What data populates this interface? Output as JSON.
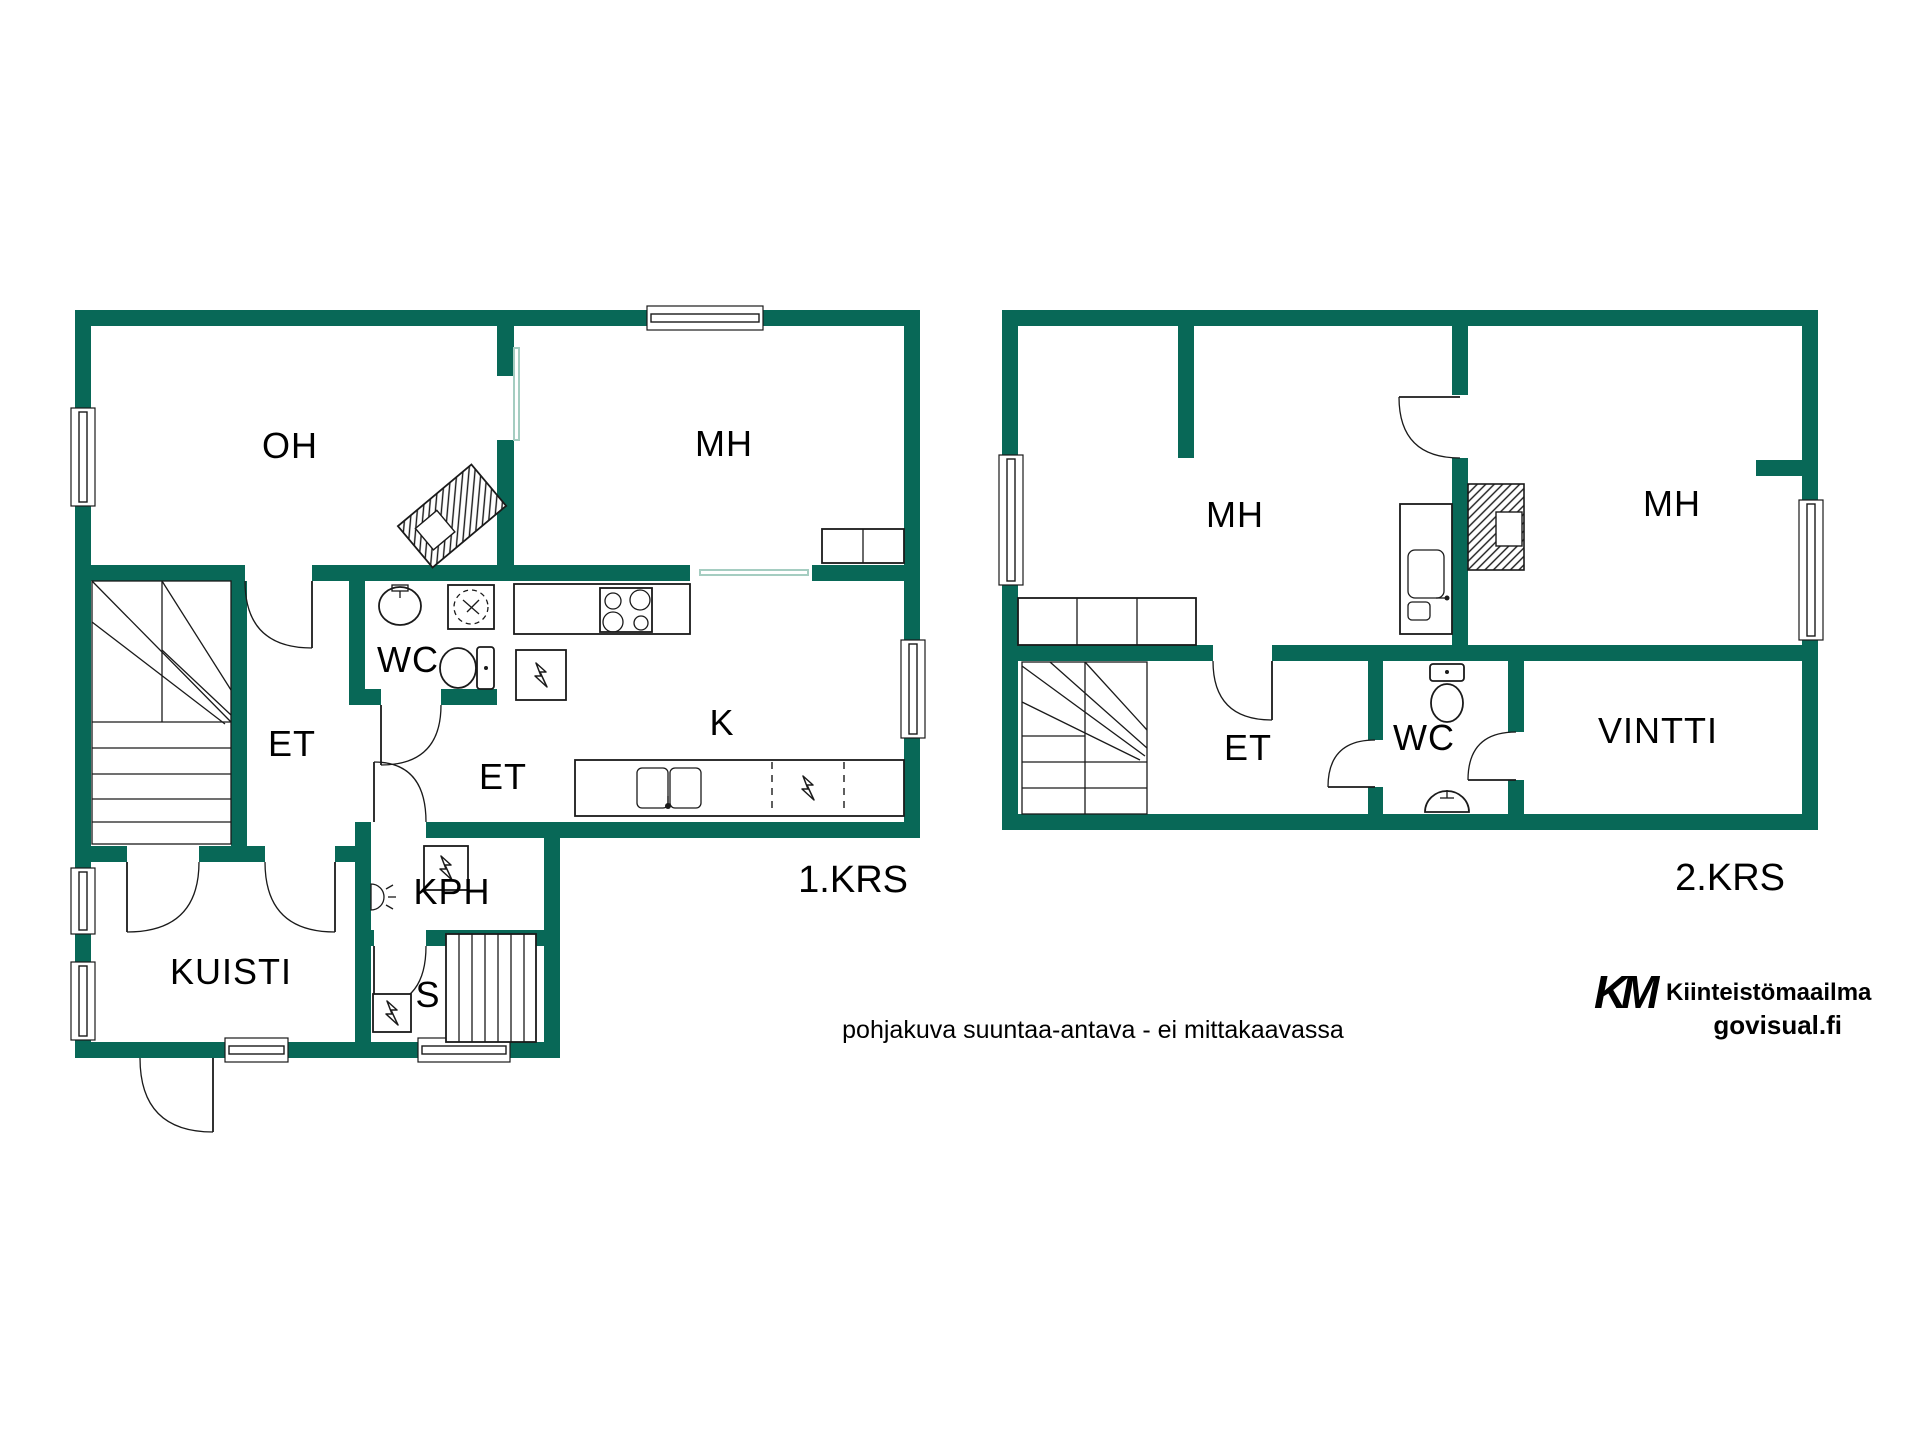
{
  "document": {
    "type": "floor-plan"
  },
  "colors": {
    "wall": "#086857",
    "line": "#1a1a1a",
    "sliding_door": "#a5cdc1",
    "disclaimer_text": "#a8a8a8",
    "logo_k": "#3cb95f",
    "logo_m": "#176a50",
    "logo_text": "#1b5c4b",
    "watermark_text": "#b7bab9"
  },
  "floors": [
    {
      "name": "1.KRS",
      "rooms": [
        {
          "id": "oh",
          "label": "OH"
        },
        {
          "id": "mh",
          "label": "MH"
        },
        {
          "id": "wc",
          "label": "WC"
        },
        {
          "id": "et-hall",
          "label": "ET"
        },
        {
          "id": "et-back",
          "label": "ET"
        },
        {
          "id": "k",
          "label": "K"
        },
        {
          "id": "kph",
          "label": "KPH"
        },
        {
          "id": "s",
          "label": "S"
        },
        {
          "id": "kuisti",
          "label": "KUISTI"
        }
      ]
    },
    {
      "name": "2.KRS",
      "rooms": [
        {
          "id": "mh-left",
          "label": "MH"
        },
        {
          "id": "mh-right",
          "label": "MH"
        },
        {
          "id": "et",
          "label": "ET"
        },
        {
          "id": "wc",
          "label": "WC"
        },
        {
          "id": "vintti",
          "label": "VINTTI"
        }
      ]
    }
  ],
  "footer": {
    "disclaimer": "pohjakuva suuntaa-antava - ei mittakaavassa"
  },
  "logo": {
    "k": "K",
    "m": "M",
    "brand": "Kiinteistömaailma",
    "site": "govisual.fi"
  }
}
